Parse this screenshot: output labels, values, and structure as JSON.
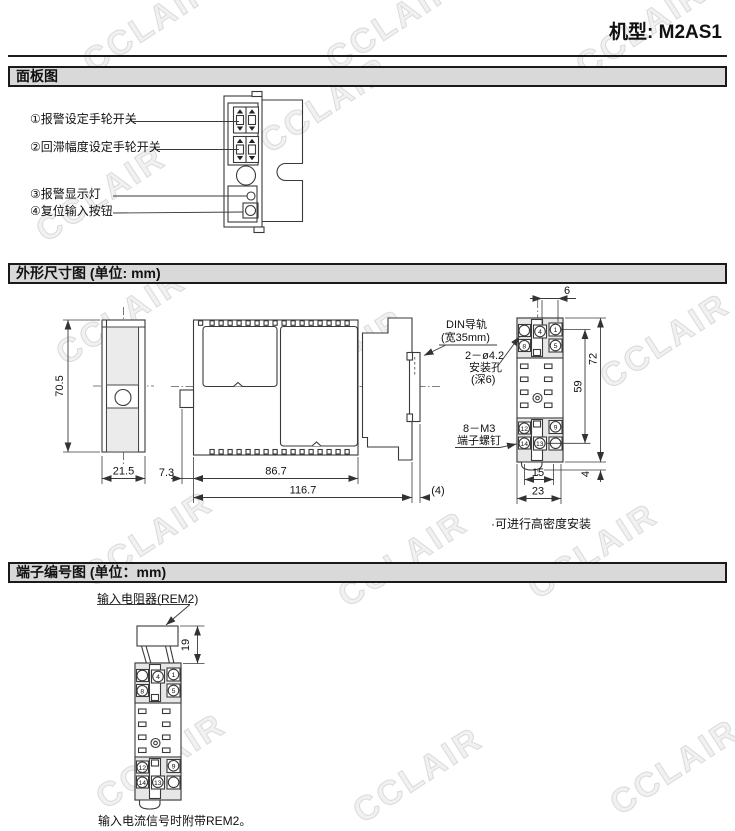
{
  "header": {
    "model": "机型: M2AS1"
  },
  "watermark": {
    "text": "CCLAIR"
  },
  "colors": {
    "section_bar_bg": "#d9d9d9",
    "line": "#3a3a3a",
    "block_fill": "#e7e7e7",
    "watermark": "#bebebe"
  },
  "panel_section": {
    "title": "面板图",
    "callouts": [
      {
        "label": "①报警设定手轮开关"
      },
      {
        "label": "②回滞幅度设定手轮开关"
      },
      {
        "label": "③报警显示灯"
      },
      {
        "label": "④复位输入按钮"
      }
    ]
  },
  "dimension_section": {
    "title": "外形尺寸图 (单位: mm)",
    "front": {
      "height": "70.5",
      "width": "21.5"
    },
    "side": {
      "offset": "7.3",
      "body_depth": "86.7",
      "total_depth": "116.7",
      "rail_extra": "(4)"
    },
    "rear": {
      "hole_offset": "6",
      "terminal_span": "59",
      "height": "72",
      "slot_width": "15",
      "width": "23",
      "tab": "4"
    },
    "din_label_1": "DIN导轨",
    "din_label_2": "(宽35mm)",
    "hole_label_1": "2－ø4.2",
    "hole_label_2": "安装孔",
    "hole_label_3": "(深6)",
    "screw_label_1": "8－M3",
    "screw_label_2": "端子螺钉",
    "note": "·可进行高密度安装",
    "rear_terminals": {
      "n1": "1",
      "n4": "4",
      "n5": "5",
      "n8": "8",
      "n9": "9",
      "n12": "12",
      "n13": "13",
      "n14": "14"
    }
  },
  "terminal_section": {
    "title": "端子编号图 (单位：mm)",
    "resistor_label": "输入电阻器(REM2)",
    "resistor_height": "19",
    "numbers": {
      "n1": "1",
      "n4": "4",
      "n5": "5",
      "n8": "8",
      "n9": "9",
      "n12": "12",
      "n13": "13",
      "n14": "14"
    },
    "caption": "输入电流信号时附带REM2。"
  }
}
